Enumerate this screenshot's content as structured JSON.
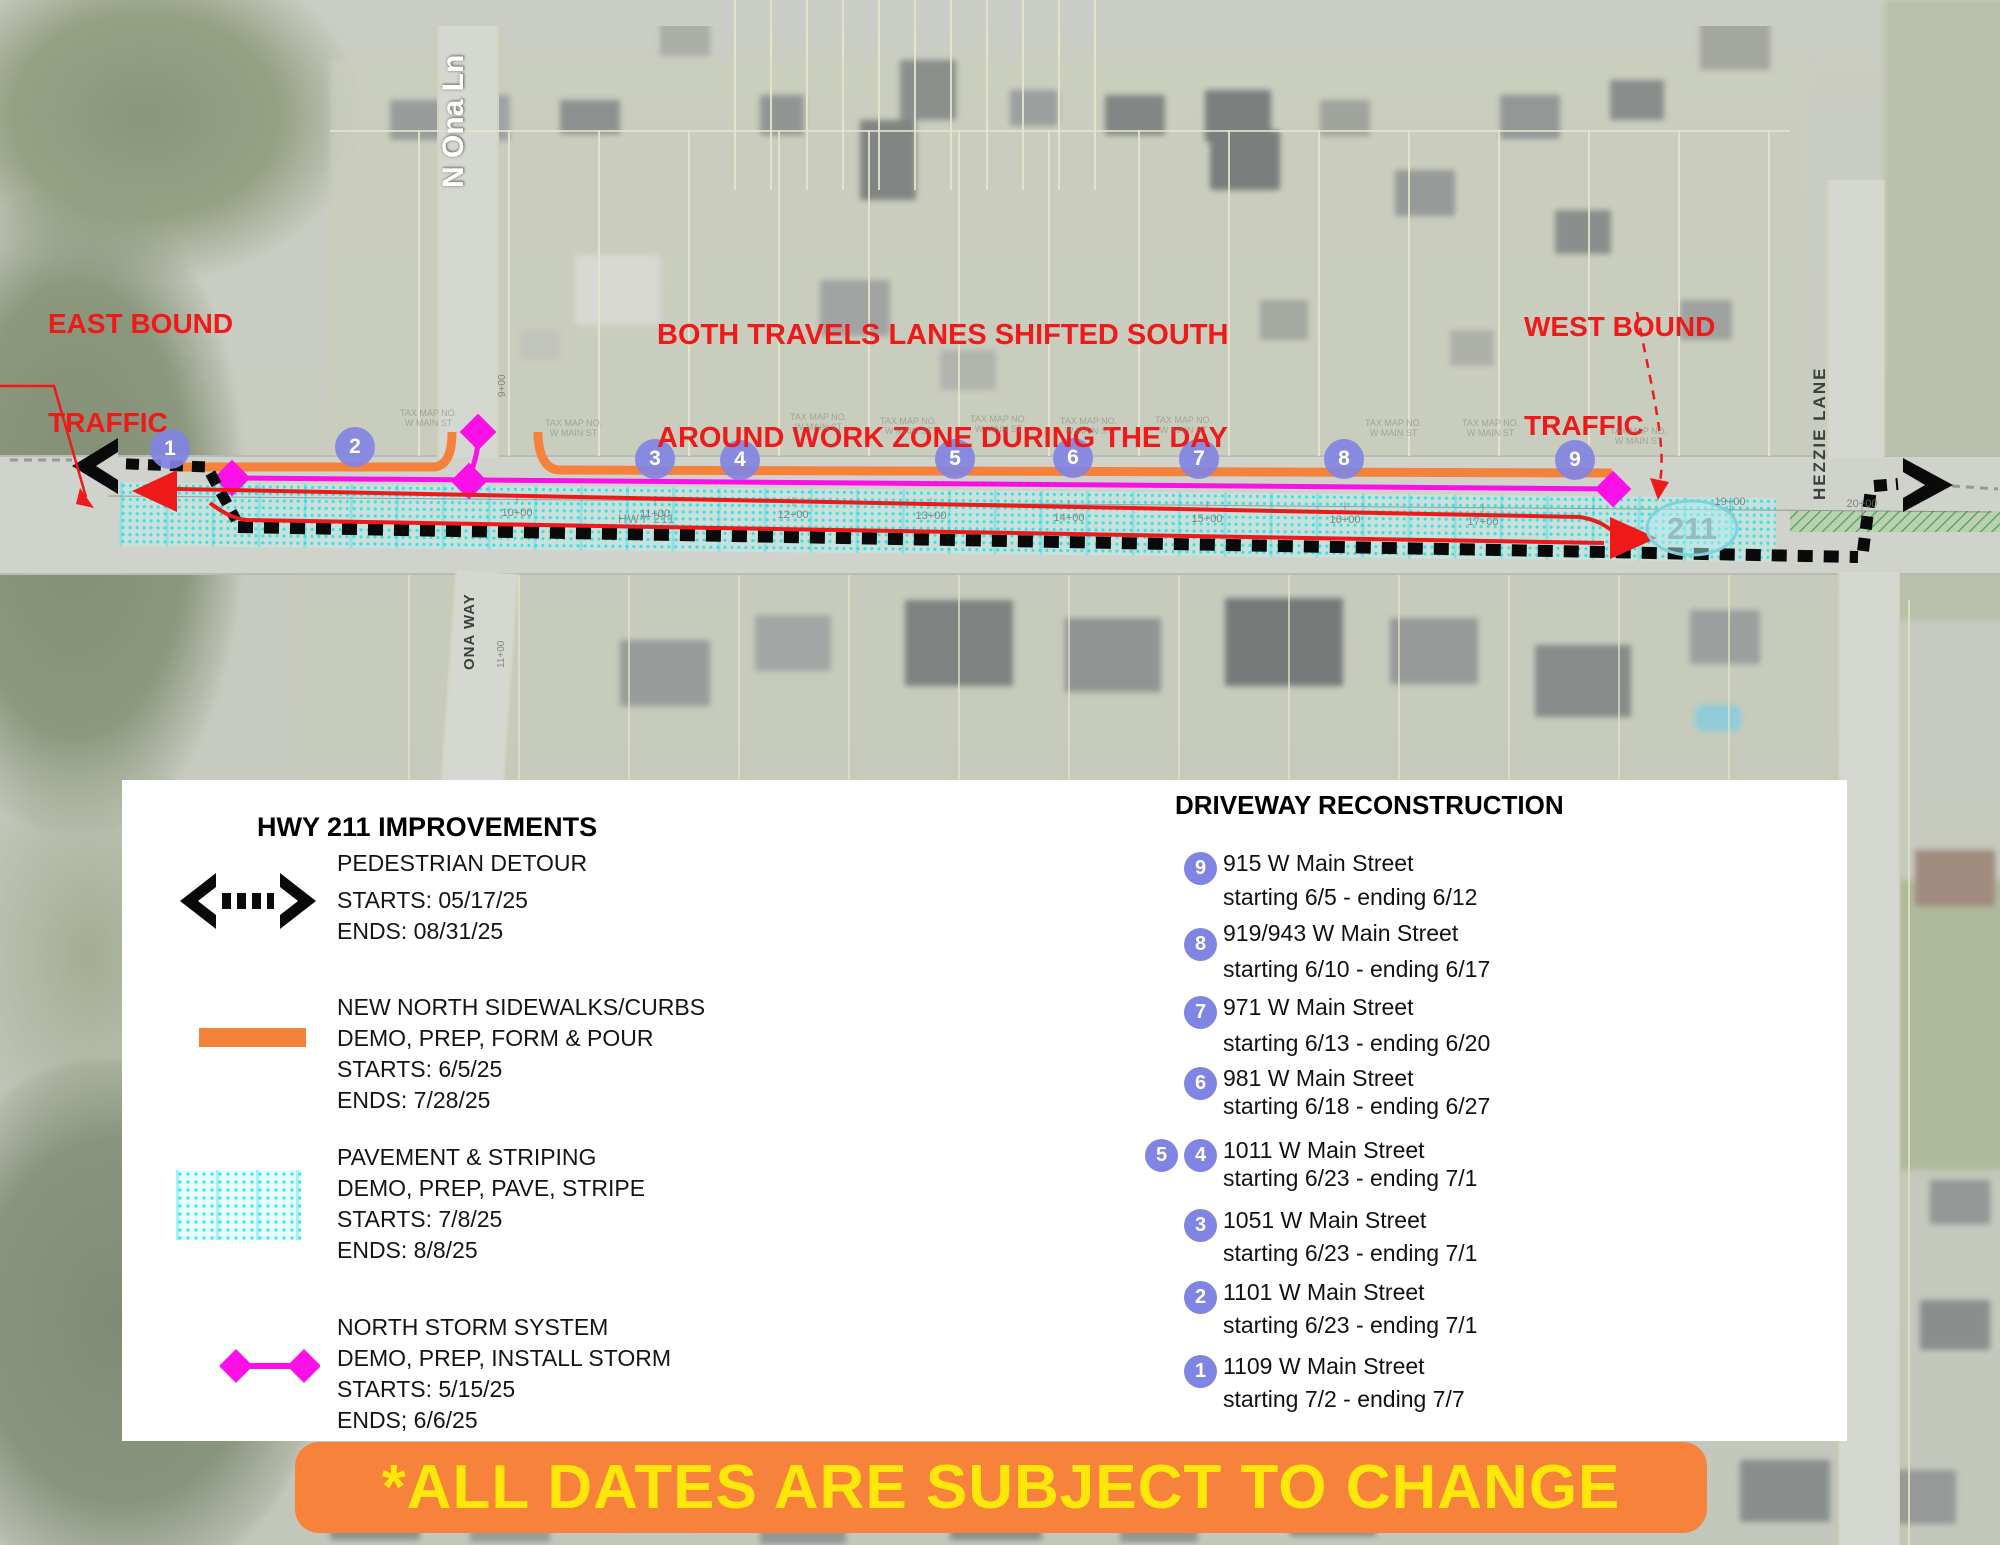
{
  "annotations": {
    "east_bound": [
      "EAST BOUND",
      "TRAFFIC"
    ],
    "shift_notice": [
      "BOTH TRAVELS LANES SHIFTED SOUTH",
      "AROUND WORK ZONE DURING THE DAY"
    ],
    "west_bound": [
      "WEST BOUND",
      "TRAFFIC"
    ]
  },
  "streets": {
    "n_ona_ln": "N Ona Ln",
    "ona_way": "ONA WAY",
    "hezzie_lane": "HEZZIE LANE",
    "hwy": "HWY 211"
  },
  "map": {
    "route_bubble": "211",
    "tax_label_line1": "TAX MAP NO.",
    "tax_label_line2": "W MAIN ST",
    "circles": [
      "1",
      "2",
      "3",
      "4",
      "5",
      "6",
      "7",
      "8",
      "9"
    ],
    "stations": [
      "10+00",
      "11+00",
      "12+00",
      "13+00",
      "14+00",
      "15+00",
      "16+00",
      "17+00",
      "19+00",
      "20+00"
    ],
    "side_stations": [
      "9+00",
      "11+00"
    ]
  },
  "legend": {
    "title": "HWY 211 IMPROVEMENTS",
    "items": [
      {
        "name": "PEDESTRIAN DETOUR",
        "lines": [
          "STARTS: 05/17/25",
          "ENDS: 08/31/25"
        ]
      },
      {
        "name": "NEW NORTH SIDEWALKS/CURBS",
        "lines": [
          "DEMO, PREP, FORM & POUR",
          "STARTS: 6/5/25",
          "ENDS: 7/28/25"
        ]
      },
      {
        "name": "PAVEMENT & STRIPING",
        "lines": [
          "DEMO, PREP, PAVE, STRIPE",
          "STARTS: 7/8/25",
          "ENDS: 8/8/25"
        ]
      },
      {
        "name": "NORTH STORM SYSTEM",
        "lines": [
          "DEMO, PREP, INSTALL STORM",
          "STARTS: 5/15/25",
          "ENDS; 6/6/25"
        ]
      }
    ]
  },
  "driveway": {
    "title": "DRIVEWAY RECONSTRUCTION",
    "items": [
      {
        "badges": [
          "9"
        ],
        "address": "915 W Main Street",
        "dates": "starting 6/5 - ending 6/12"
      },
      {
        "badges": [
          "8"
        ],
        "address": "919/943 W Main Street",
        "dates": "starting 6/10 - ending 6/17"
      },
      {
        "badges": [
          "7"
        ],
        "address": "971 W Main Street",
        "dates": "starting 6/13 - ending 6/20"
      },
      {
        "badges": [
          "6"
        ],
        "address": "981 W Main Street",
        "dates": "starting 6/18 - ending 6/27"
      },
      {
        "badges": [
          "5",
          "4"
        ],
        "address": "1011 W Main Street",
        "dates": "starting 6/23 - ending 7/1"
      },
      {
        "badges": [
          "3"
        ],
        "address": "1051 W Main Street",
        "dates": "starting 6/23 - ending 7/1"
      },
      {
        "badges": [
          "2"
        ],
        "address": "1101 W Main Street",
        "dates": "starting 6/23 - ending 7/1"
      },
      {
        "badges": [
          "1"
        ],
        "address": "1109 W Main Street",
        "dates": "starting 7/2 - ending 7/7"
      }
    ]
  },
  "banner": {
    "text": "*ALL DATES ARE SUBJECT TO CHANGE"
  },
  "colors": {
    "orange": "#F5823A",
    "magenta": "#FB10E8",
    "cyan": "#06E1E8",
    "red": "#EE1A1A",
    "circle_purple": "#8084E2",
    "banner_text": "#FFE70A"
  }
}
